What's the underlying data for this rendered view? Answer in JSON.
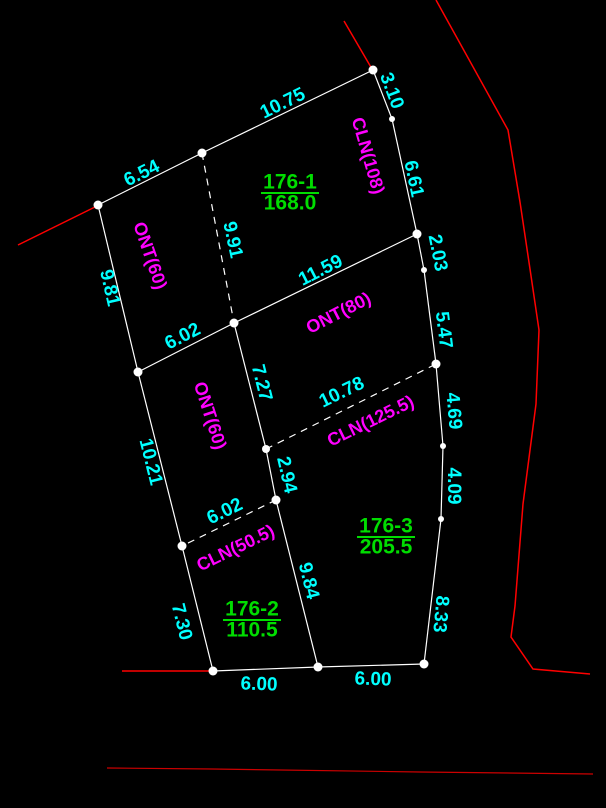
{
  "app": {
    "type": "cadastral-parcel-drawing",
    "background": "#000000"
  },
  "colors": {
    "boundary": "#ffffff",
    "vertex": "#ffffff",
    "dimension_text": "#00ffff",
    "street_text": "#ff00ff",
    "parcel_text": "#00dd00",
    "road": "#ff0000",
    "far_road": "#cc0000"
  },
  "drawing": {
    "width": 606,
    "height": 808,
    "vertices": [
      {
        "id": "M",
        "x": 98,
        "y": 205,
        "r": 4.5
      },
      {
        "id": "A",
        "x": 202,
        "y": 153,
        "r": 4.5
      },
      {
        "id": "B",
        "x": 373,
        "y": 70,
        "r": 4.5
      },
      {
        "id": "C",
        "x": 392,
        "y": 119,
        "r": 3
      },
      {
        "id": "D",
        "x": 417,
        "y": 234,
        "r": 4.5
      },
      {
        "id": "E",
        "x": 424,
        "y": 270,
        "r": 3
      },
      {
        "id": "F",
        "x": 436,
        "y": 364,
        "r": 4.5
      },
      {
        "id": "G",
        "x": 443,
        "y": 446,
        "r": 3
      },
      {
        "id": "H",
        "x": 441,
        "y": 519,
        "r": 3
      },
      {
        "id": "I",
        "x": 424,
        "y": 664,
        "r": 4.5
      },
      {
        "id": "J",
        "x": 318,
        "y": 667,
        "r": 4.5
      },
      {
        "id": "K",
        "x": 213,
        "y": 671,
        "r": 4.5
      },
      {
        "id": "L",
        "x": 182,
        "y": 546,
        "r": 4.5
      },
      {
        "id": "N",
        "x": 138,
        "y": 372,
        "r": 4.5
      },
      {
        "id": "O",
        "x": 234,
        "y": 323,
        "r": 4.5
      },
      {
        "id": "P",
        "x": 266,
        "y": 449,
        "r": 4
      },
      {
        "id": "Q",
        "x": 276,
        "y": 500,
        "r": 4.5
      }
    ],
    "segments": [
      {
        "a": "M",
        "b": "A",
        "dash": false,
        "len": "6.54",
        "lx": 142,
        "ly": 174,
        "rot": -26
      },
      {
        "a": "A",
        "b": "B",
        "dash": false,
        "len": "10.75",
        "lx": 283,
        "ly": 104,
        "rot": -26
      },
      {
        "a": "B",
        "b": "C",
        "dash": false,
        "len": "3.10",
        "lx": 391,
        "ly": 91,
        "rot": 69
      },
      {
        "a": "C",
        "b": "D",
        "dash": false,
        "len": "6.61",
        "lx": 413,
        "ly": 179,
        "rot": 78
      },
      {
        "a": "D",
        "b": "E",
        "dash": false,
        "len": "2.03",
        "lx": 437,
        "ly": 253,
        "rot": 79
      },
      {
        "a": "E",
        "b": "F",
        "dash": false,
        "len": "5.47",
        "lx": 443,
        "ly": 330,
        "rot": 83
      },
      {
        "a": "F",
        "b": "G",
        "dash": false,
        "len": "4.69",
        "lx": 453,
        "ly": 411,
        "rot": 85
      },
      {
        "a": "G",
        "b": "H",
        "dash": false,
        "len": "4.09",
        "lx": 453,
        "ly": 486,
        "rot": 90
      },
      {
        "a": "H",
        "b": "I",
        "dash": false,
        "len": "8.33",
        "lx": 440,
        "ly": 614,
        "rot": 95
      },
      {
        "a": "I",
        "b": "J",
        "dash": false,
        "len": "6.00",
        "lx": 373,
        "ly": 680,
        "rot": 2
      },
      {
        "a": "J",
        "b": "K",
        "dash": false,
        "len": "6.00",
        "lx": 259,
        "ly": 685,
        "rot": 2
      },
      {
        "a": "K",
        "b": "L",
        "dash": false,
        "len": "7.30",
        "lx": 181,
        "ly": 622,
        "rot": 76
      },
      {
        "a": "L",
        "b": "N",
        "dash": false,
        "len": "10.21",
        "lx": 150,
        "ly": 462,
        "rot": 76
      },
      {
        "a": "N",
        "b": "M",
        "dash": false,
        "len": "9.81",
        "lx": 109,
        "ly": 288,
        "rot": 77
      },
      {
        "a": "O",
        "b": "D",
        "dash": false,
        "len": "11.59",
        "lx": 321,
        "ly": 271,
        "rot": -27
      },
      {
        "a": "O",
        "b": "N",
        "dash": false,
        "len": "6.02",
        "lx": 183,
        "ly": 337,
        "rot": -27
      },
      {
        "a": "O",
        "b": "P",
        "dash": false,
        "len": "7.27",
        "lx": 261,
        "ly": 383,
        "rot": 76
      },
      {
        "a": "P",
        "b": "Q",
        "dash": false,
        "len": "2.94",
        "lx": 286,
        "ly": 475,
        "rot": 77
      },
      {
        "a": "Q",
        "b": "J",
        "dash": false,
        "len": "9.84",
        "lx": 308,
        "ly": 581,
        "rot": 76
      },
      {
        "a": "A",
        "b": "O",
        "dash": true,
        "len": "9.91",
        "lx": 232,
        "ly": 240,
        "rot": 78
      },
      {
        "a": "P",
        "b": "F",
        "dash": true,
        "len": "10.78",
        "lx": 342,
        "ly": 393,
        "rot": -26
      },
      {
        "a": "Q",
        "b": "L",
        "dash": true,
        "len": "6.02",
        "lx": 225,
        "ly": 512,
        "rot": -26
      }
    ],
    "street_labels": [
      {
        "text": "CLN(108)",
        "x": 367,
        "y": 156,
        "rot": 74
      },
      {
        "text": "ONT(60)",
        "x": 149,
        "y": 256,
        "rot": 71
      },
      {
        "text": "ONT(80)",
        "x": 339,
        "y": 314,
        "rot": -27
      },
      {
        "text": "CLN(125.5)",
        "x": 371,
        "y": 422,
        "rot": -26
      },
      {
        "text": "ONT(60)",
        "x": 209,
        "y": 416,
        "rot": 72
      },
      {
        "text": "CLN(50.5)",
        "x": 236,
        "y": 549,
        "rot": -26
      }
    ],
    "parcels": [
      {
        "name": "176-1",
        "area": "168.0",
        "x": 290,
        "y": 183
      },
      {
        "name": "176-2",
        "area": "110.5",
        "x": 252,
        "y": 610
      },
      {
        "name": "176-3",
        "area": "205.5",
        "x": 386,
        "y": 527
      }
    ],
    "roads": [
      {
        "name": "road-east-edge",
        "width": 1.5,
        "color": "road",
        "pts": [
          [
            436,
            0
          ],
          [
            508,
            130
          ],
          [
            513,
            160
          ],
          [
            520,
            202
          ],
          [
            530,
            269
          ],
          [
            539,
            330
          ],
          [
            536,
            404
          ],
          [
            523,
            504
          ],
          [
            515,
            606
          ],
          [
            511,
            637
          ],
          [
            533,
            669
          ],
          [
            590,
            674
          ]
        ]
      },
      {
        "name": "road-stub-north",
        "width": 1.5,
        "color": "road",
        "pts": [
          [
            344,
            21
          ],
          [
            372,
            69
          ]
        ]
      },
      {
        "name": "road-stub-west",
        "width": 1.5,
        "color": "road",
        "pts": [
          [
            18,
            245
          ],
          [
            97,
            206
          ]
        ]
      },
      {
        "name": "road-stub-southwest",
        "width": 1.5,
        "color": "road",
        "pts": [
          [
            122,
            671
          ],
          [
            212,
            671
          ]
        ]
      },
      {
        "name": "road-south-edge",
        "width": 1.2,
        "color": "far_road",
        "pts": [
          [
            107,
            768
          ],
          [
            212,
            769
          ],
          [
            420,
            772
          ],
          [
            593,
            774
          ]
        ]
      }
    ]
  }
}
